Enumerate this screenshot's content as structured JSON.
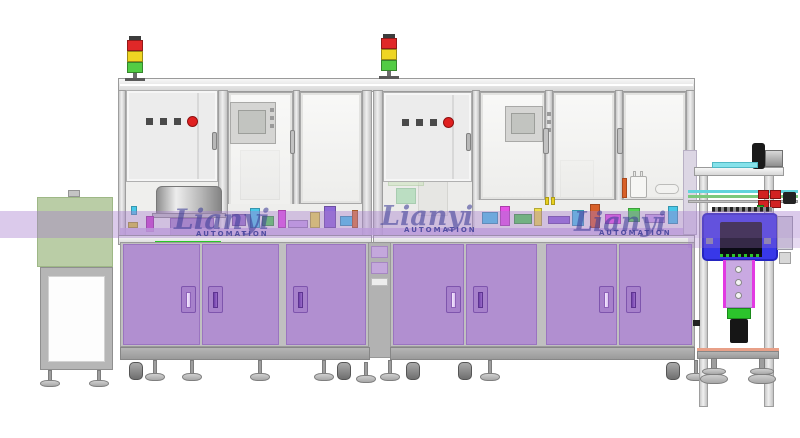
{
  "watermark": {
    "brand": "Lianyi",
    "subtitle": "AUTOMATION"
  },
  "palette": {
    "cabinet_purple": "#b18fd0",
    "conveyor_band": "rgba(165,122,206,0.40)",
    "oven_blue": "#3838e8",
    "frame_gray": "#dcdcdc",
    "infeed_green_box": "#bacda6",
    "signal_red": "#e02828",
    "signal_yellow": "#efd522",
    "signal_green": "#52cc44"
  },
  "stations": {
    "infeed": "infeed-conveyor-station",
    "module1": "assembly-module-1",
    "module2": "assembly-module-2",
    "outfeed": "vision-inspection-station"
  }
}
